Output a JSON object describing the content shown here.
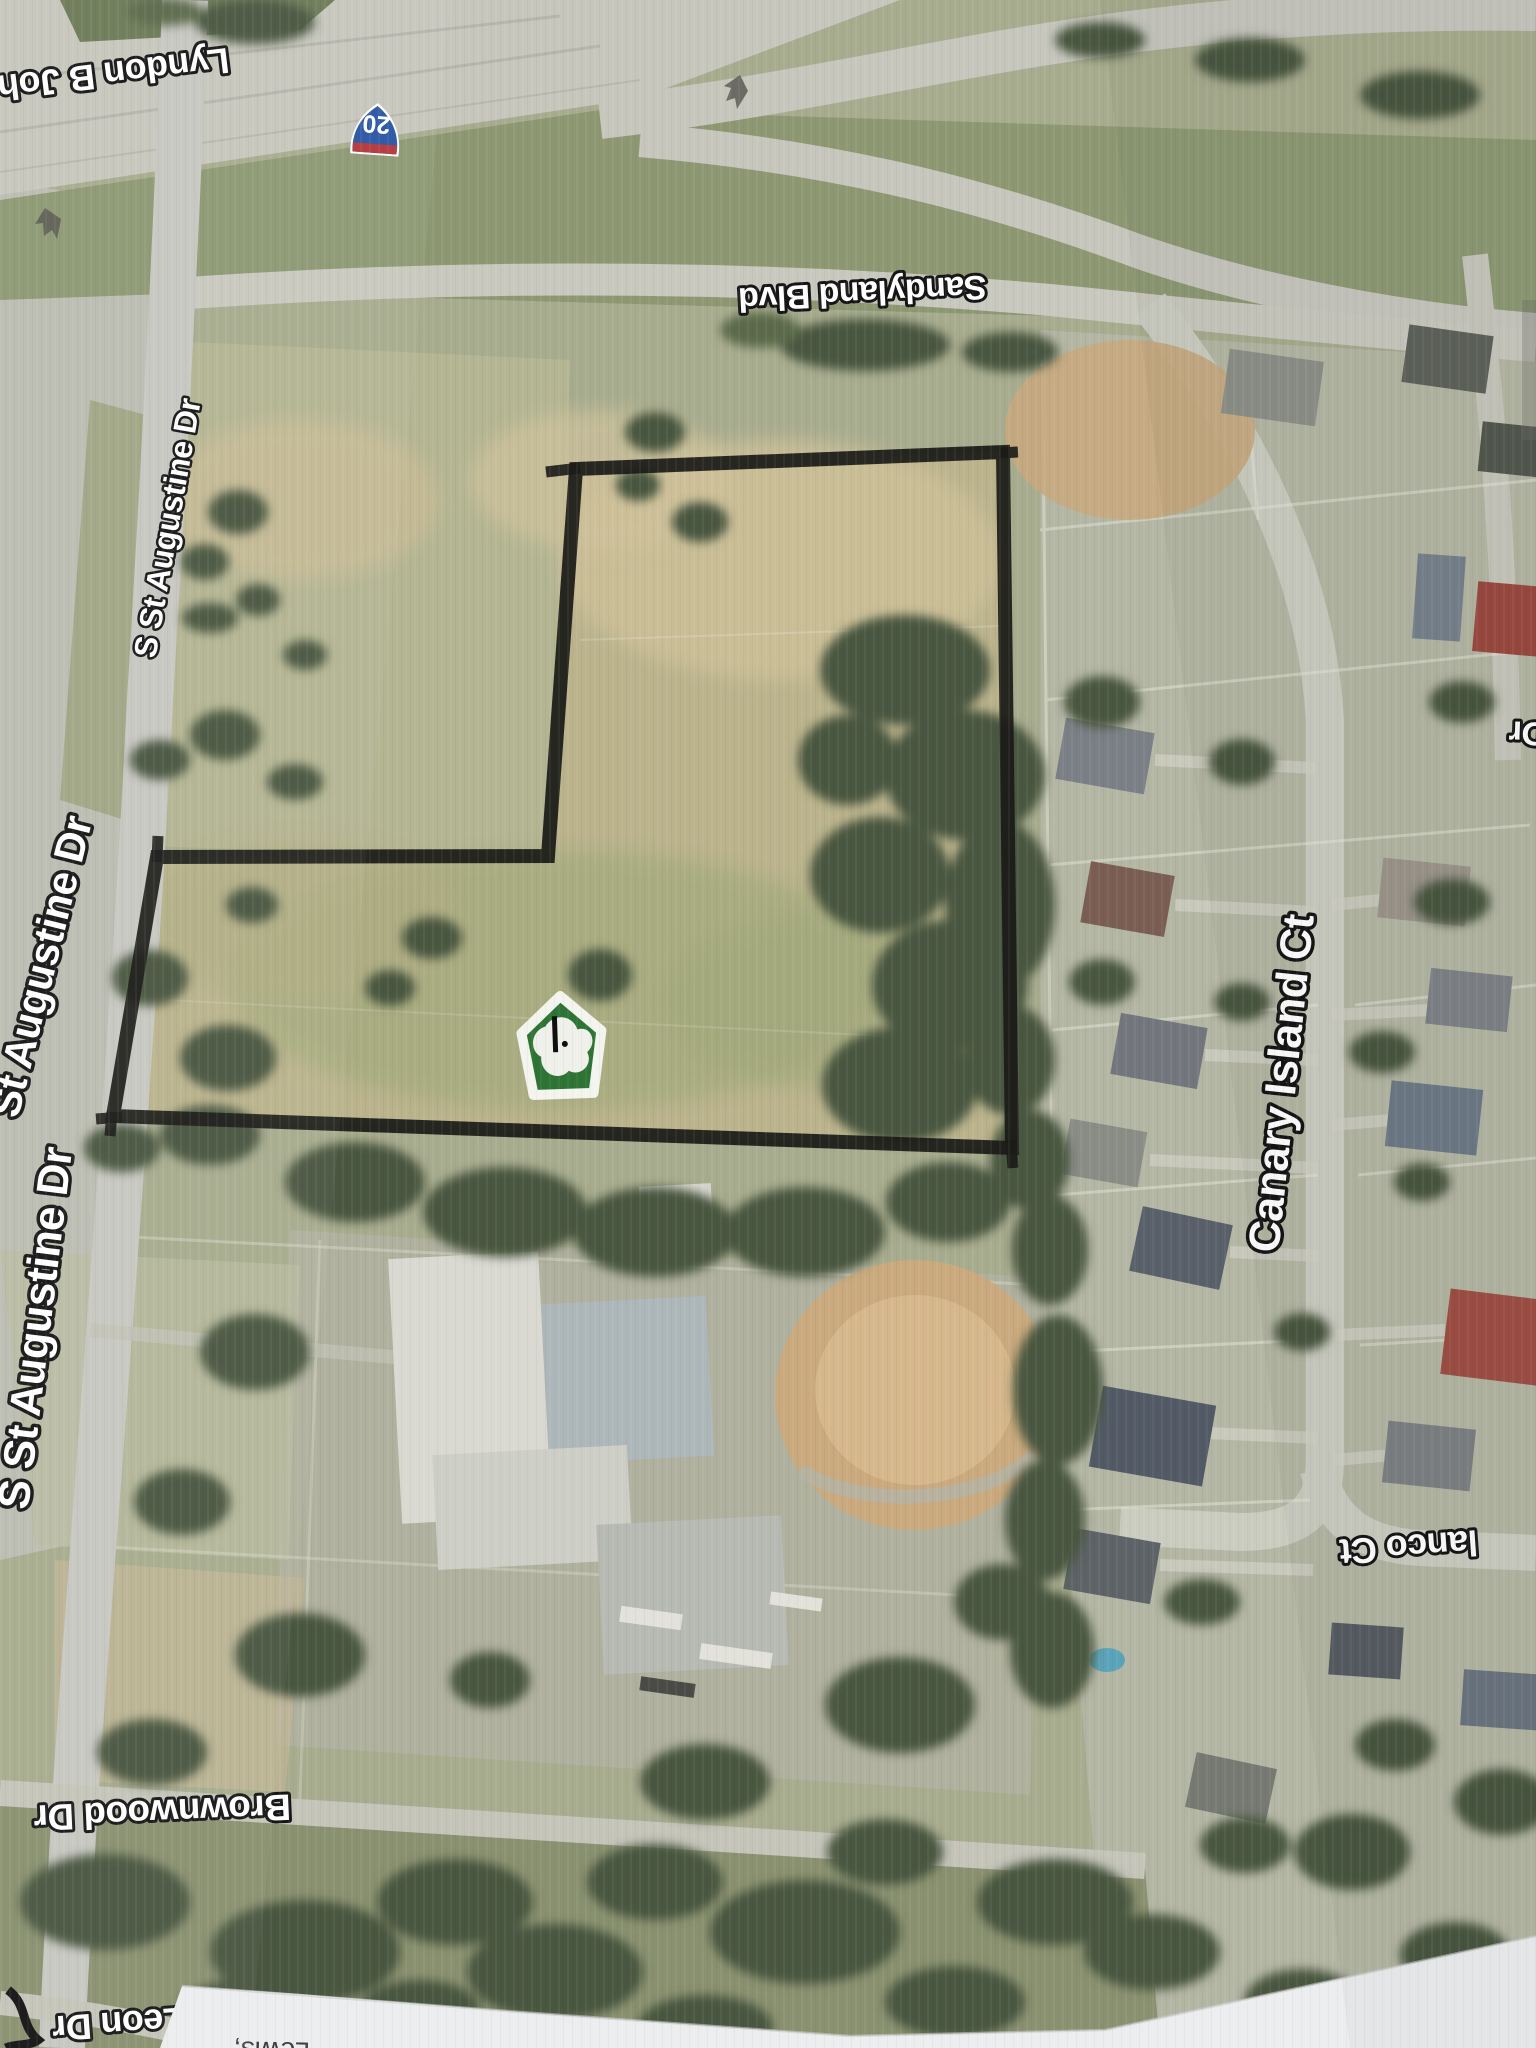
{
  "streets": {
    "freeway_label": "Lyndon B Joh",
    "interstate_shield_number": "20",
    "sandyland": "Sandyland Blvd",
    "augustine_top": "S St Augustine Dr",
    "augustine_middle": "St Augustine Dr",
    "augustine_bottom": "S St Augustine Dr",
    "canary_island": "Canary Island Ct",
    "lanco": "lanco Ct",
    "brownwood": "Brownwood Dr",
    "leon": "Leon Dr",
    "right_edge_partial": "Dr"
  },
  "annotations": {
    "bottom_paper_text": "Lewis,"
  },
  "icons": {
    "marker": "green-house-shield-logo",
    "shield": "interstate-highway-shield"
  },
  "colors": {
    "parcel_outline": "#1b1b18",
    "marker_green": "#2e7435",
    "shield_blue": "#2a56a4",
    "shield_red": "#b5373b",
    "label_fill": "#ffffff",
    "label_outline": "#151515",
    "paper_white": "#ecedee"
  }
}
